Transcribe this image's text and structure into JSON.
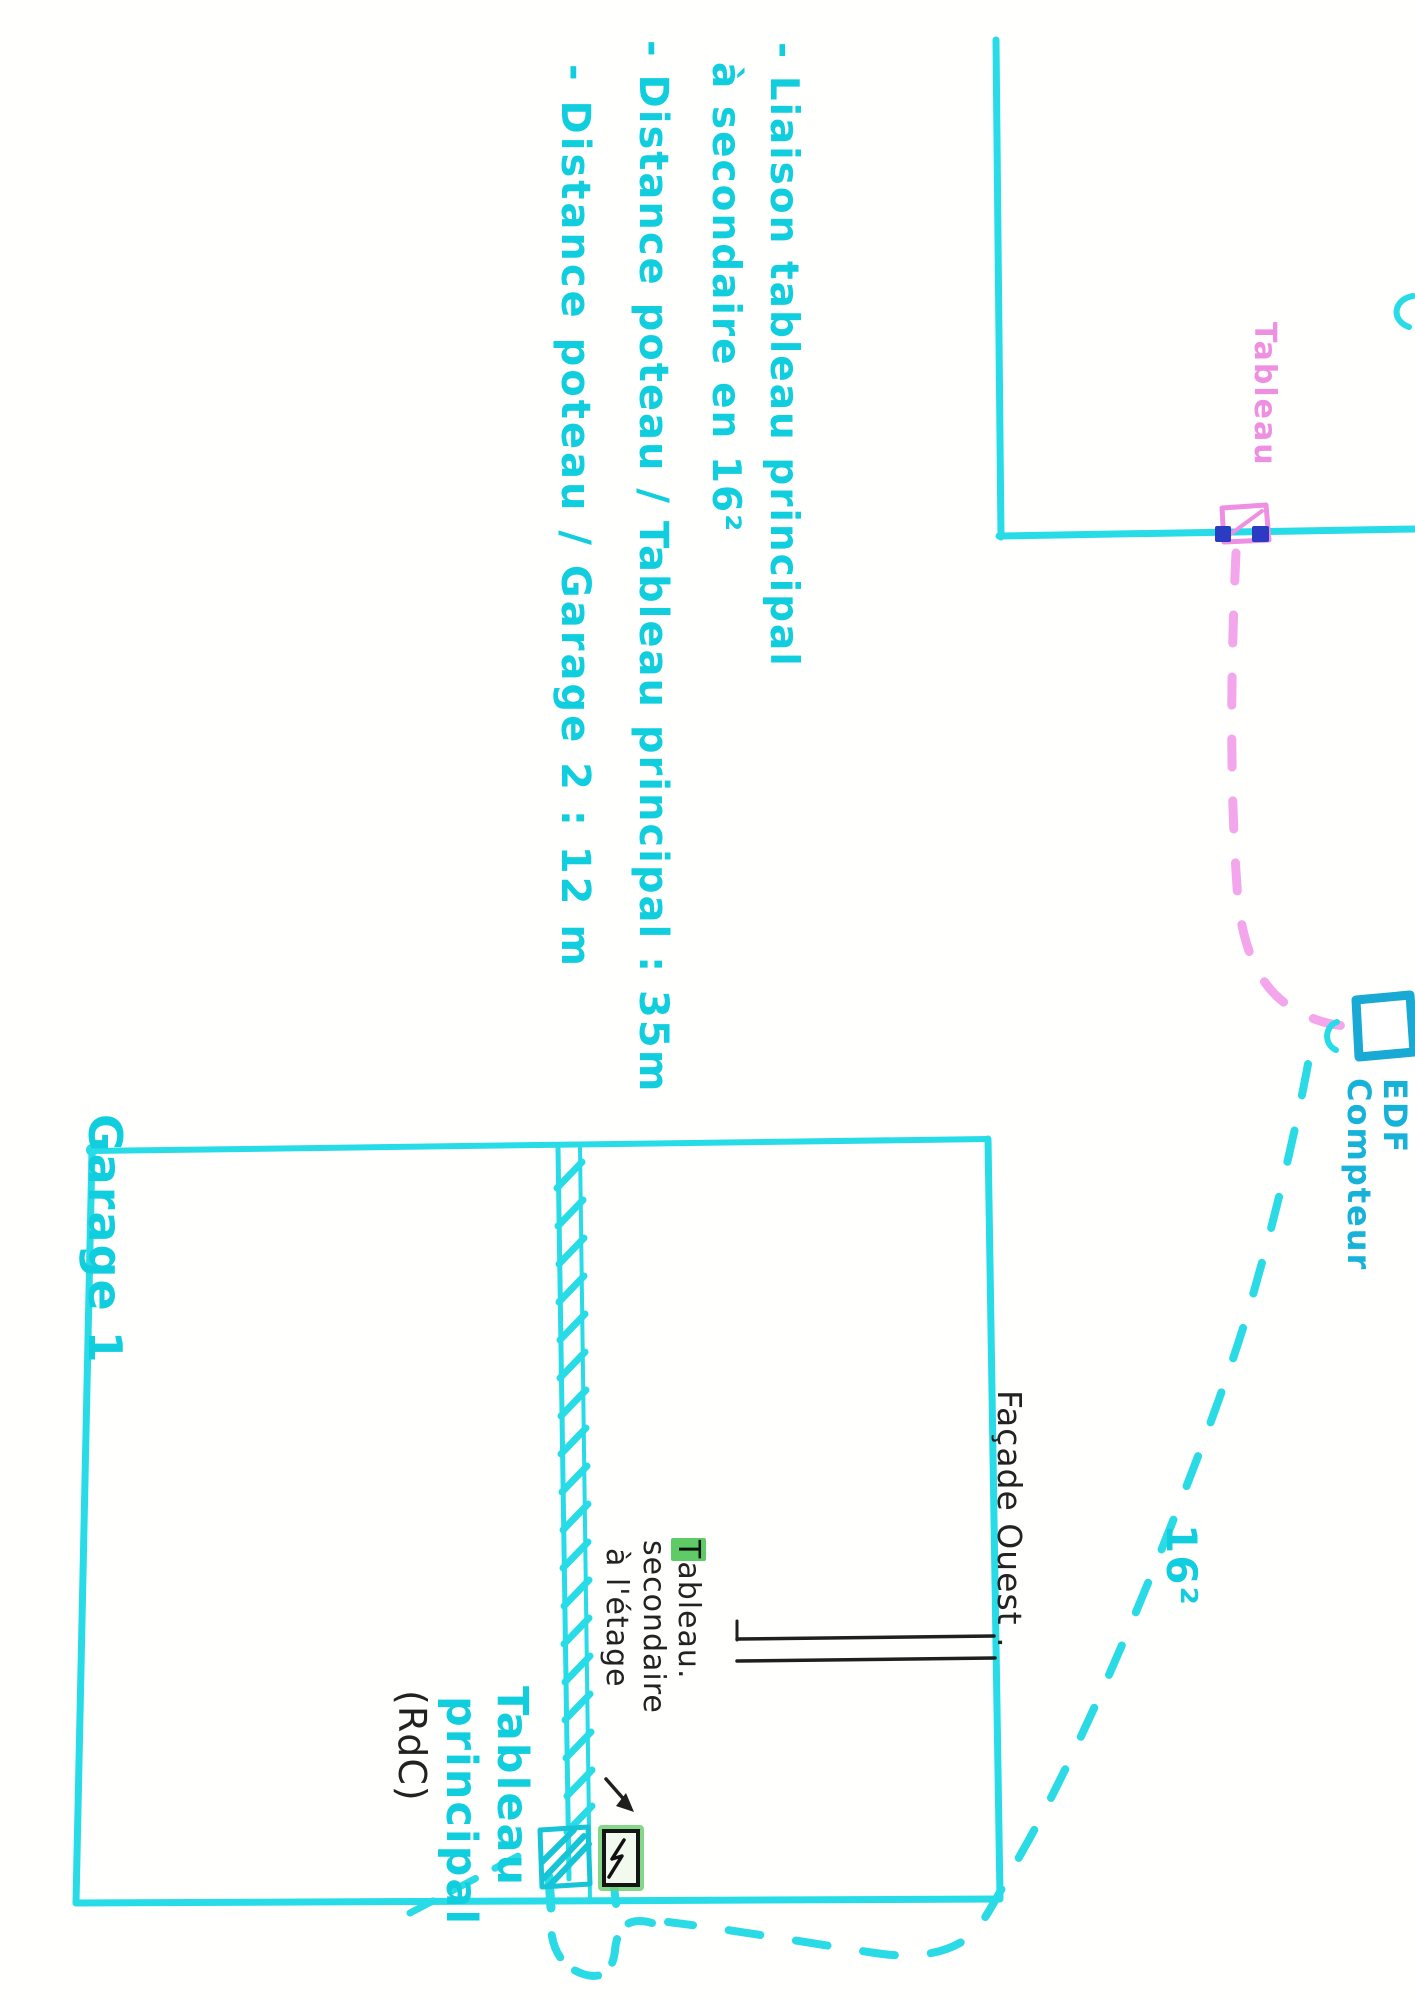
{
  "title": "Plan electrique croquis",
  "colors": {
    "cyan_line": "#27dbe7",
    "cyan_text": "#10cede",
    "teal_box": "#18a9d4",
    "pink": "#ee8fe2",
    "pink_dash": "#f3a6ec",
    "navy": "#2b3cc2",
    "ink": "#222222",
    "green_highlight": "#5ecb67"
  },
  "notes": {
    "lines": [
      "- Liaison tableau principal",
      "à secondaire en 16²",
      "- Distance poteau / Tableau principal : 35m",
      "- Distance poteau / Garage 2 : 12 m"
    ]
  },
  "upper_building": {
    "board_label": "Tableau"
  },
  "edf": {
    "line1": "EDF",
    "line2": "Compteur"
  },
  "cable": {
    "section_label": "16²"
  },
  "garage": {
    "name_label": "Garage 1",
    "facade_label": "Façade Ouest .",
    "main_board_line1": "Tableau",
    "main_board_line2": "principal",
    "floor_label": "(RdC)"
  },
  "secondary_board": {
    "line1_head": "T",
    "line1_tail": "ableau.",
    "line2": "secondaire",
    "line3": "à l'étage"
  }
}
